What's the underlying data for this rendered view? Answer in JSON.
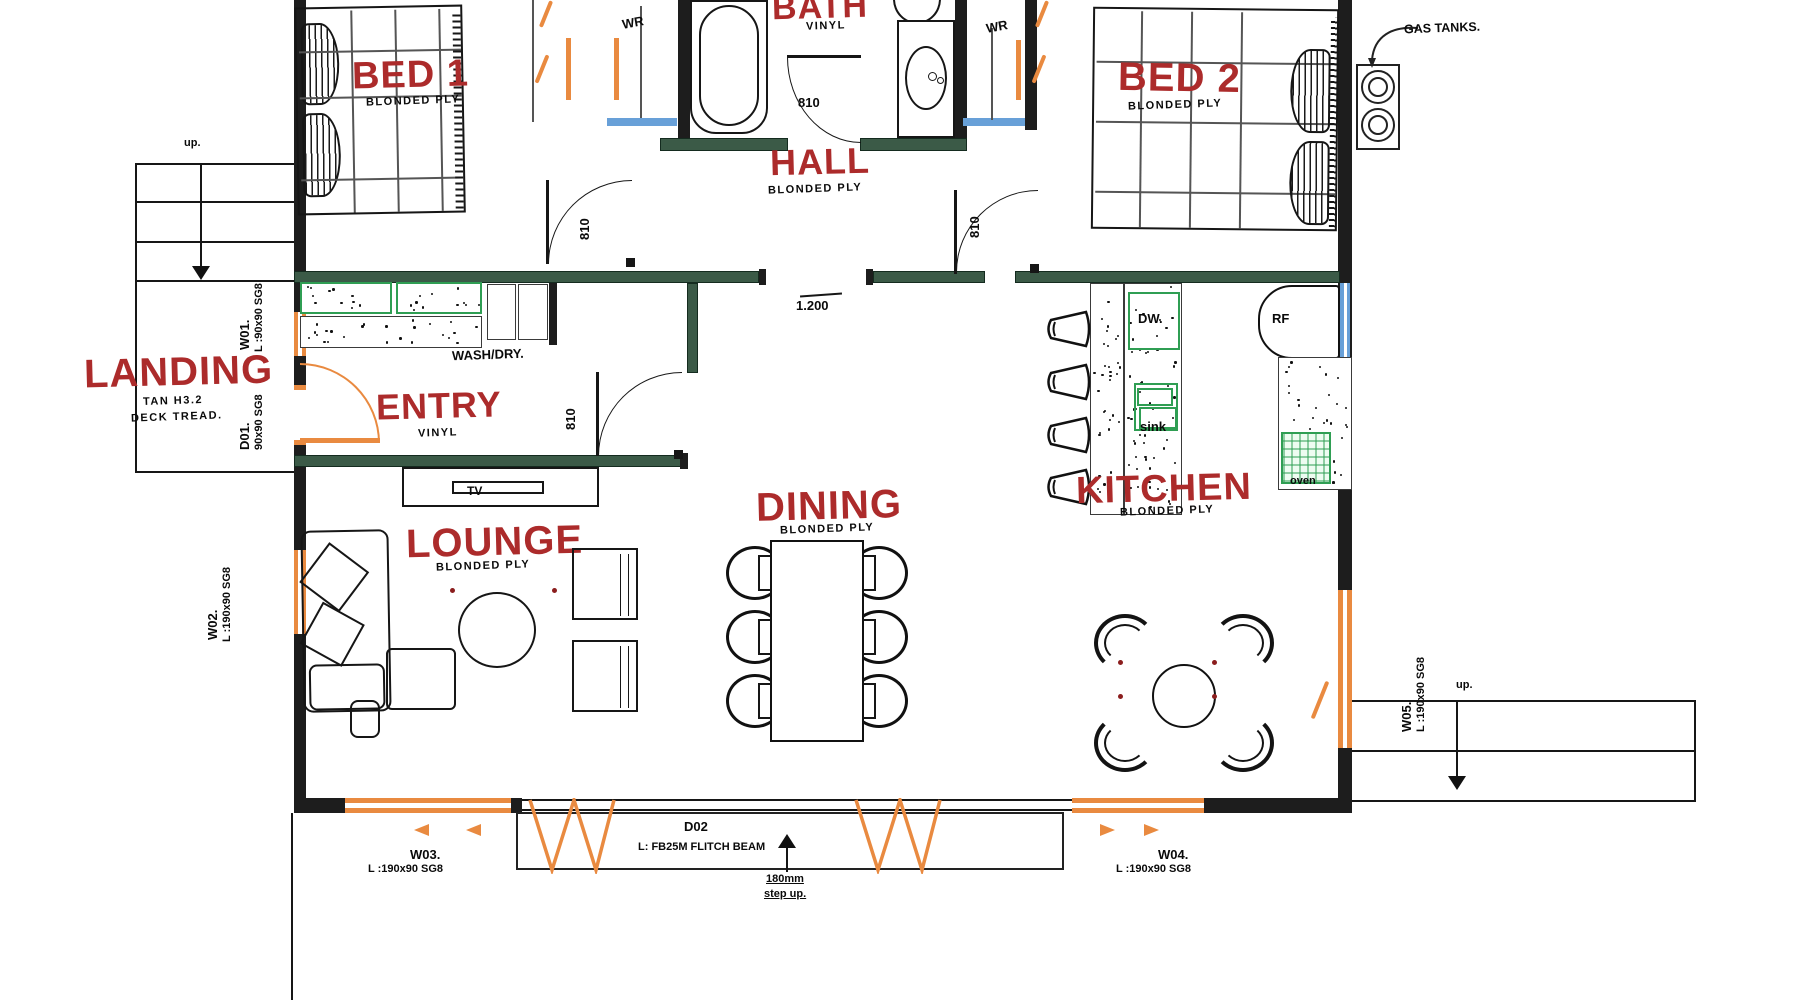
{
  "colors": {
    "label_red": "#ac2b2b",
    "wall_dark": "#1d1d1d",
    "wall_green": "#3b5a47",
    "cabinet_green": "#2f9e53",
    "window_orange": "#e98a40",
    "window_blue": "#68a0d8"
  },
  "rooms": {
    "bed1": {
      "name": "BED 1",
      "floor": "BLONDED PLY"
    },
    "bath": {
      "name": "BATH",
      "floor": "VINYL"
    },
    "hall": {
      "name": "HALL",
      "floor": "BLONDED PLY"
    },
    "bed2": {
      "name": "BED 2",
      "floor": "BLONDED PLY"
    },
    "landing": {
      "name": "LANDING",
      "floor": "TAN H3.2",
      "floor2": "DECK TREAD."
    },
    "entry": {
      "name": "ENTRY",
      "floor": "VINYL"
    },
    "lounge": {
      "name": "LOUNGE",
      "floor": "BLONDED PLY"
    },
    "dining": {
      "name": "DINING",
      "floor": "BLONDED PLY"
    },
    "kitchen": {
      "name": "KITCHEN",
      "floor": "BLONDED PLY"
    }
  },
  "fixtures": {
    "wash_dry": "WASH/DRY.",
    "tv": "TV",
    "dishwasher": "DW.",
    "sink": "sink",
    "fridge": "RF",
    "oven": "oven",
    "wardrobe1": "WR",
    "wardrobe2": "WR",
    "gas_tanks": "GAS TANKS."
  },
  "stairs": {
    "up_left": "up.",
    "up_right": "up."
  },
  "dimensions": {
    "hall_opening": "1.200",
    "step_height": "180mm",
    "step_note": "step up."
  },
  "door_widths": [
    "810",
    "810",
    "810",
    "810"
  ],
  "openings": {
    "w01": {
      "id": "W01.",
      "spec": "L :90x90 SG8"
    },
    "d01": {
      "id": "D01.",
      "spec": "90x90 SG8"
    },
    "w02": {
      "id": "W02.",
      "spec": "L :190x90 SG8"
    },
    "w03": {
      "id": "W03.",
      "spec": "L :190x90 SG8"
    },
    "w04": {
      "id": "W04.",
      "spec": "L :190x90 SG8"
    },
    "w05": {
      "id": "W05.",
      "spec": "L :190x90 SG8"
    },
    "d02": {
      "id": "D02",
      "spec": "L: FB25M FLITCH BEAM"
    }
  }
}
